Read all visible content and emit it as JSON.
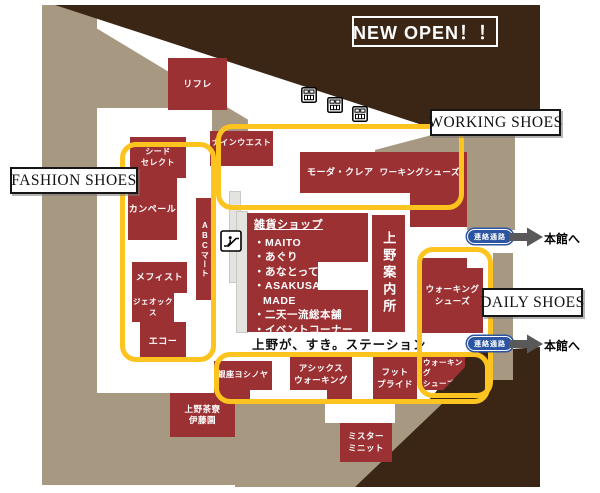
{
  "banner": {
    "text": "NEW OPEN！！"
  },
  "zone_labels": {
    "fashion": "FASHION SHOES",
    "working": "WORKING SHOES",
    "daily": "DAILY SHOES"
  },
  "stores": {
    "rifure": "リフレ",
    "nine_west": "ナインウエスト",
    "seed_select": [
      "シード",
      "セレクト"
    ],
    "campere": "カンペール",
    "abc_mart": "ABCマート",
    "mephisto": "メフィスト",
    "geox": "ジェオックス",
    "ecco": "エコー",
    "moda_clea": "モーダ・クレア",
    "working_shoes": "ワーキングシューズ",
    "walking_shoes_main": [
      "ウォーキング",
      "シューズ"
    ],
    "ginza_yoshinoya": "銀座ヨシノヤ",
    "asics_walking": [
      "アシックス",
      "ウォーキング"
    ],
    "foot_pride": [
      "フット",
      "プライド"
    ],
    "walking_shoes_south": [
      "ウォーキング",
      "シューズ"
    ],
    "mister_minit": [
      "ミスター",
      "ミニット"
    ],
    "ueno_saryo_itoen": [
      "上野茶寮",
      "伊藤園"
    ]
  },
  "zakka_shop": {
    "title": "雑貨ショップ",
    "items": [
      "・MAITO",
      "・あぐり",
      "・あなとって",
      "・ASAKUSA",
      "MADE",
      "・二天一流総本舗",
      "・イベントコーナー"
    ]
  },
  "info_center": "上野案内所",
  "caption": "上野が、すき。ステーション",
  "passage": {
    "label": "連絡通路",
    "destination": "本館へ"
  },
  "colors": {
    "store_red": "#9c3134",
    "floor_tan": "#a79882",
    "accent_brown": "#3b2616",
    "zone_yellow": "#fdc31f",
    "passage_blue": "#2b55a2",
    "arrow_gray": "#595959"
  }
}
